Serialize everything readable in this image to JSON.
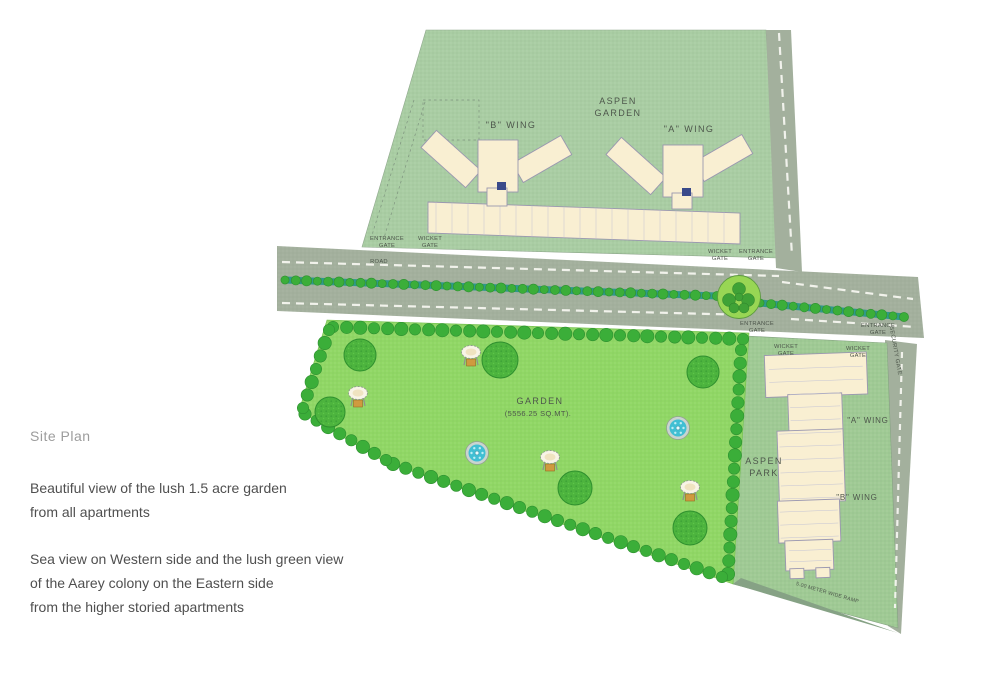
{
  "colors": {
    "aspen-garden-green": "#a9cda3",
    "park-green": "#9fca94",
    "garden-green": "#90d765",
    "road-gray": "#a3b09d",
    "building-cream": "#f9efd2",
    "building-stroke": "#9a97b0",
    "tree-dark": "#3bae39",
    "tree-big": "#4db43e",
    "median-teal": "#2f998a",
    "water-blue": "#41bfd3",
    "label-ink": "#4d564b",
    "text-gray": "#4f4f4f",
    "title-gray": "#9c9c9c"
  },
  "sidebar": {
    "title": "Site Plan",
    "paragraph1": [
      "Beautiful view of the lush 1.5 acre garden",
      "from all apartments"
    ],
    "paragraph2": [
      "Sea view on Western side and the lush green view",
      "of the Aarey colony on the Eastern side",
      "from the higher storied apartments"
    ]
  },
  "plan": {
    "aspen_garden": {
      "line1": "ASPEN",
      "line2": "GARDEN",
      "b_wing": "\"B\" WING",
      "a_wing": "\"A\" WING"
    },
    "aspen_park": {
      "line1": "ASPEN",
      "line2": "PARK",
      "a_wing": "\"A\" WING",
      "b_wing": "\"B\" WING"
    },
    "garden": {
      "label": "GARDEN",
      "area": "(5556.25 SQ.MT)."
    },
    "road": "ROAD",
    "security_gate": "SECURITY GATE",
    "ramp": "5.00 METER WIDE RAMP",
    "gates": [
      {
        "line1": "ENTRANCE",
        "line2": "GATE",
        "x": 387,
        "y": 240
      },
      {
        "line1": "WICKET",
        "line2": "GATE",
        "x": 430,
        "y": 240
      },
      {
        "line1": "WICKET",
        "line2": "GATE",
        "x": 720,
        "y": 253
      },
      {
        "line1": "ENTRANCE",
        "line2": "GATE",
        "x": 756,
        "y": 253
      },
      {
        "line1": "ENTRANCE",
        "line2": "GATE",
        "x": 757,
        "y": 325
      },
      {
        "line1": "ENTRANCE",
        "line2": "GATE",
        "x": 878,
        "y": 327
      },
      {
        "line1": "WICKET",
        "line2": "GATE",
        "x": 786,
        "y": 348
      },
      {
        "line1": "WICKET",
        "line2": "GATE",
        "x": 858,
        "y": 350
      }
    ]
  },
  "map": {
    "big_trees": [
      [
        360,
        355,
        16
      ],
      [
        330,
        412,
        15
      ],
      [
        500,
        360,
        18
      ],
      [
        703,
        372,
        16
      ],
      [
        575,
        488,
        17
      ],
      [
        690,
        528,
        17
      ]
    ],
    "fountains": [
      [
        477,
        453
      ],
      [
        678,
        428
      ]
    ],
    "gazebos": [
      [
        471,
        352
      ],
      [
        358,
        393
      ],
      [
        550,
        457
      ],
      [
        690,
        487
      ]
    ],
    "garden_border": [
      [
        333,
        327,
        743,
        339
      ],
      [
        741,
        350,
        728,
        574
      ],
      [
        722,
        577,
        393,
        464
      ],
      [
        386,
        460,
        305,
        414
      ],
      [
        303,
        408,
        329,
        330
      ]
    ],
    "median": [
      [
        285,
        280,
        717,
        296
      ],
      [
        760,
        303,
        904,
        317
      ]
    ],
    "roundabout": {
      "cx": 739,
      "cy": 297,
      "r": 21.5,
      "cluster": [
        [
          739,
          289,
          6.5
        ],
        [
          729,
          300,
          6.5
        ],
        [
          748,
          300,
          6.5
        ],
        [
          734,
          308,
          5
        ],
        [
          744,
          308,
          5
        ],
        [
          739,
          297,
          4
        ]
      ]
    }
  }
}
